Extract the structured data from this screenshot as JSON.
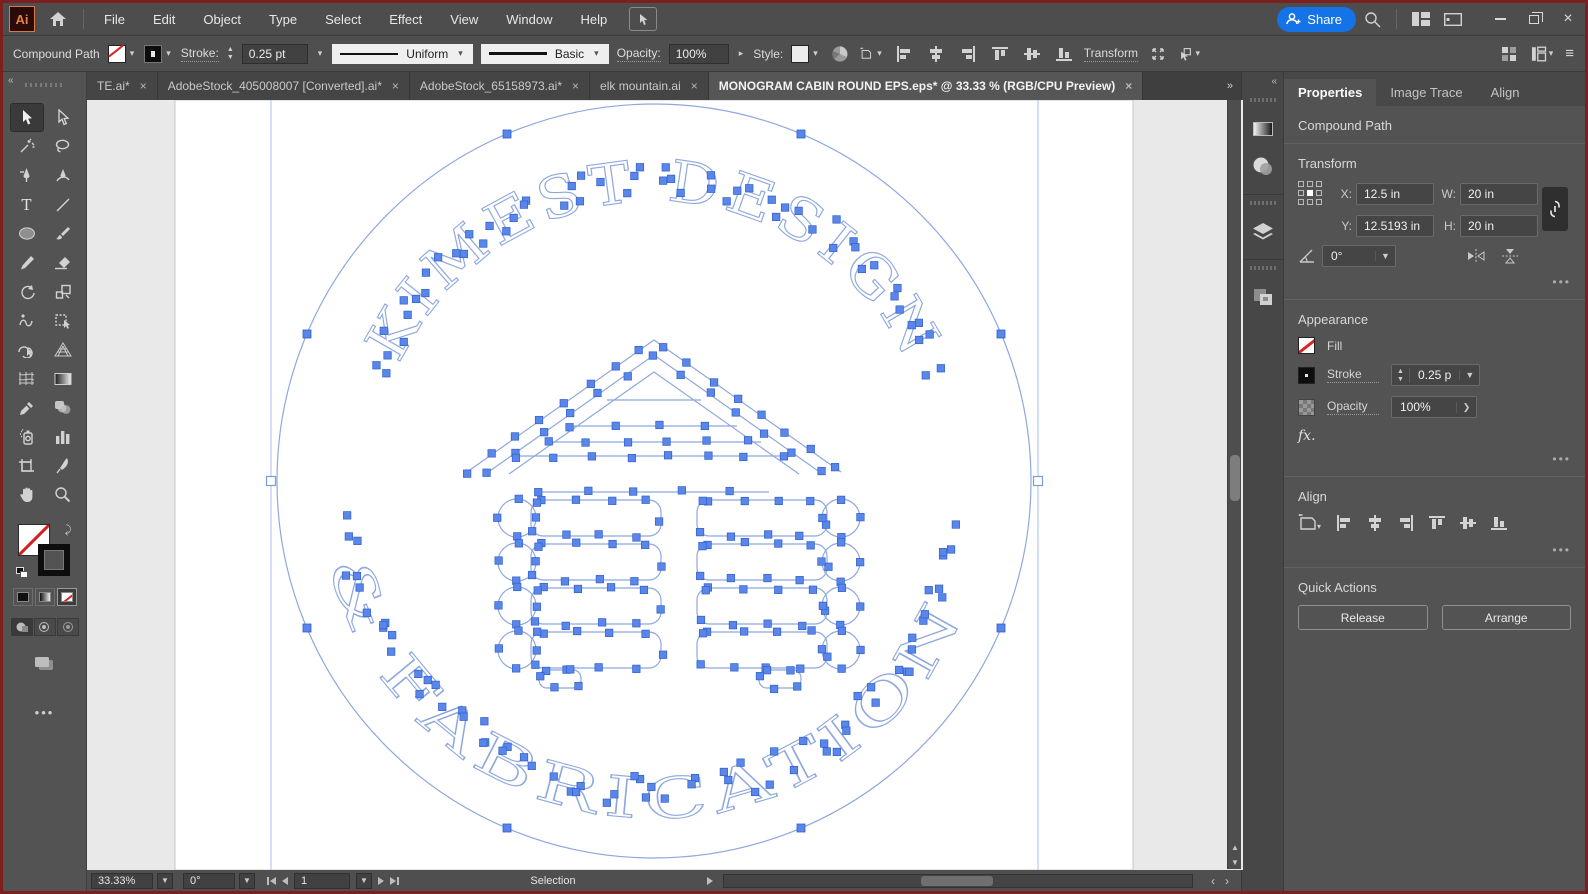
{
  "menu": {
    "items": [
      "File",
      "Edit",
      "Object",
      "Type",
      "Select",
      "Effect",
      "View",
      "Window",
      "Help"
    ]
  },
  "titlebar": {
    "share_label": "Share"
  },
  "control_bar": {
    "context_label": "Compound Path",
    "stroke_label": "Stroke:",
    "stroke_value": "0.25 pt",
    "variable_width_profile": "Uniform",
    "brush_definition": "Basic",
    "opacity_label": "Opacity:",
    "opacity_value": "100%",
    "style_label": "Style:",
    "transform_label": "Transform"
  },
  "tabs": [
    {
      "label": "TE.ai*"
    },
    {
      "label": "AdobeStock_405008007 [Converted].ai*"
    },
    {
      "label": "AdobeStock_65158973.ai*"
    },
    {
      "label": "elk mountain.ai"
    },
    {
      "label": "MONOGRAM CABIN ROUND EPS.eps* @ 33.33 % (RGB/CPU Preview)"
    }
  ],
  "artwork": {
    "arc_text_top": "KIMEST DESIGN",
    "arc_text_bottom": "& FABRICATION",
    "subject": "log cabin monogram in circle, compound path selected with anchor points"
  },
  "properties_panel": {
    "tabs": [
      "Properties",
      "Image Trace",
      "Align"
    ],
    "selection_type": "Compound Path",
    "transform": {
      "title": "Transform",
      "x_label": "X:",
      "x_value": "12.5 in",
      "y_label": "Y:",
      "y_value": "12.5193 in",
      "w_label": "W:",
      "w_value": "20 in",
      "h_label": "H:",
      "h_value": "20 in",
      "angle_value": "0°"
    },
    "appearance": {
      "title": "Appearance",
      "fill_label": "Fill",
      "stroke_label": "Stroke",
      "stroke_value": "0.25 p",
      "opacity_label": "Opacity",
      "opacity_value": "100%",
      "fx_label": "fx."
    },
    "align": {
      "title": "Align"
    },
    "quick_actions": {
      "title": "Quick Actions",
      "release_label": "Release",
      "arrange_label": "Arrange"
    }
  },
  "status_bar": {
    "zoom": "33.33%",
    "rotation": "0°",
    "artboard_number": "1",
    "tool": "Selection"
  },
  "icons": {
    "share-person-icon": "person with plus",
    "search-icon": "magnifier",
    "layout-icon": "panel grid",
    "artboard-icon": "tablet",
    "minimize-icon": "bar",
    "restore-icon": "overlapping squares",
    "close-icon": "×"
  },
  "colors": {
    "accent_blue": "#1473e6",
    "selection_blue": "#5a86e8",
    "path_blue": "#8ea8de",
    "window_border": "#7c1f1f"
  }
}
